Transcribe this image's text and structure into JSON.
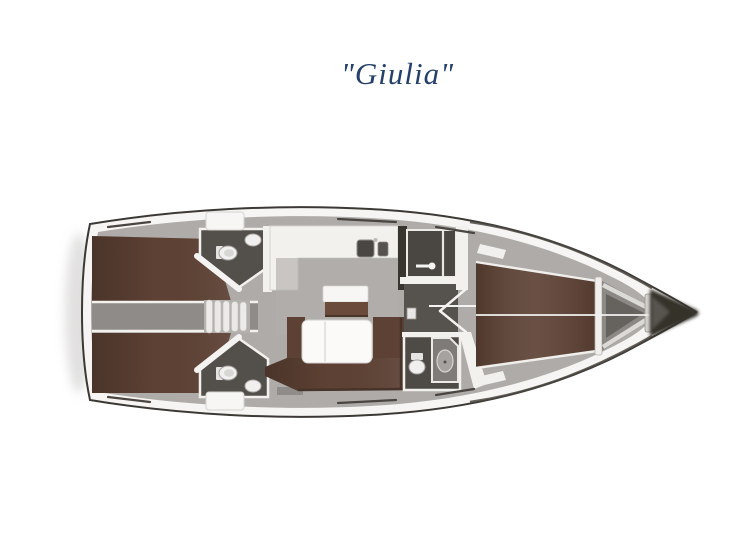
{
  "title": "\"Giulia\"",
  "diagram": {
    "kind": "sailing-yacht-floor-plan",
    "orientation": "bow-right",
    "rooms": [
      "aft-cabin-port",
      "aft-cabin-starboard",
      "aft-head-port",
      "aft-head-starboard",
      "companionway-stairs",
      "galley",
      "chart-table",
      "salon-sofa",
      "salon-table",
      "shower-room",
      "forward-head",
      "forward-cabin-v-berth",
      "anchor-locker",
      "bow-tip"
    ]
  },
  "colors": {
    "title_text": "#25406a",
    "hull_outline": "#3c3935",
    "deck_white": "#f6f5f3",
    "floor_gray": "#aeaba8",
    "corridor_gray": "#8e8b88",
    "bed_brown": "#5d4134",
    "sofa_brown": "#5d4134",
    "wood_brown": "#6a4a3a",
    "head_dark": "#534f4b",
    "fixture_white": "#f1f0ee",
    "bow_tip_dark": "#35312c",
    "shadow_gray": "#c9c8c6"
  }
}
